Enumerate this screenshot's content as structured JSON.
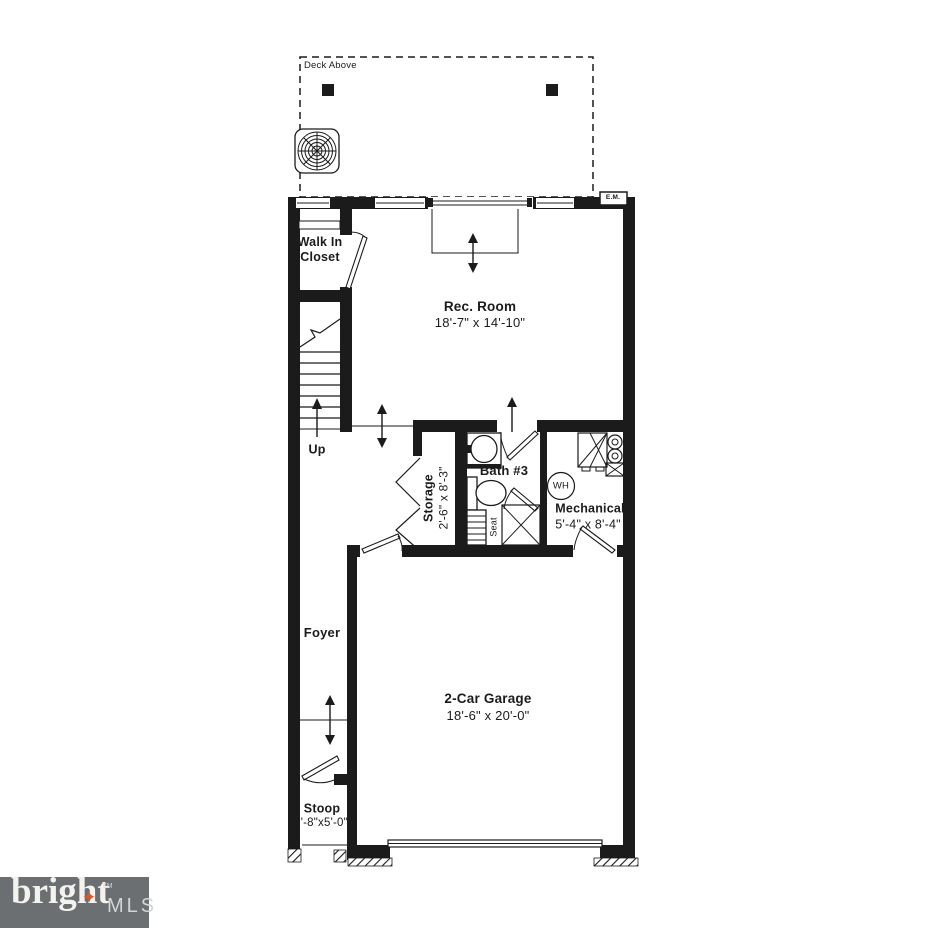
{
  "plan": {
    "deck_label": "Deck Above",
    "closet_label": "Walk In Closet",
    "rec_room": {
      "name": "Rec. Room",
      "dims": "18'-7\" x 14'-10\""
    },
    "up_label": "Up",
    "storage": {
      "name": "Storage",
      "dims": "2'-6\" x 8'-3\""
    },
    "bath_label": "Bath #3",
    "seat_label": "Seat",
    "wh_label": "WH",
    "mechanical": {
      "name": "Mechanical",
      "dims": "5'-4\" x 8'-4\""
    },
    "meter_label": "E.M.",
    "foyer_label": "Foyer",
    "garage": {
      "name": "2-Car Garage",
      "dims": "18'-6\" x 20'-0\""
    },
    "stoop": {
      "name": "Stoop",
      "dims": "3'-8\"x5'-0\""
    }
  },
  "branding": {
    "name": "bright",
    "tm": "TM",
    "suffix": "MLS",
    "star": "✦"
  },
  "colors": {
    "line": "#1b1b1b",
    "logo_bar": "#6b6f71",
    "logo_accent": "#d7572c",
    "logo_name": "#f4f2ee",
    "logo_suffix": "#d2d5d6"
  }
}
